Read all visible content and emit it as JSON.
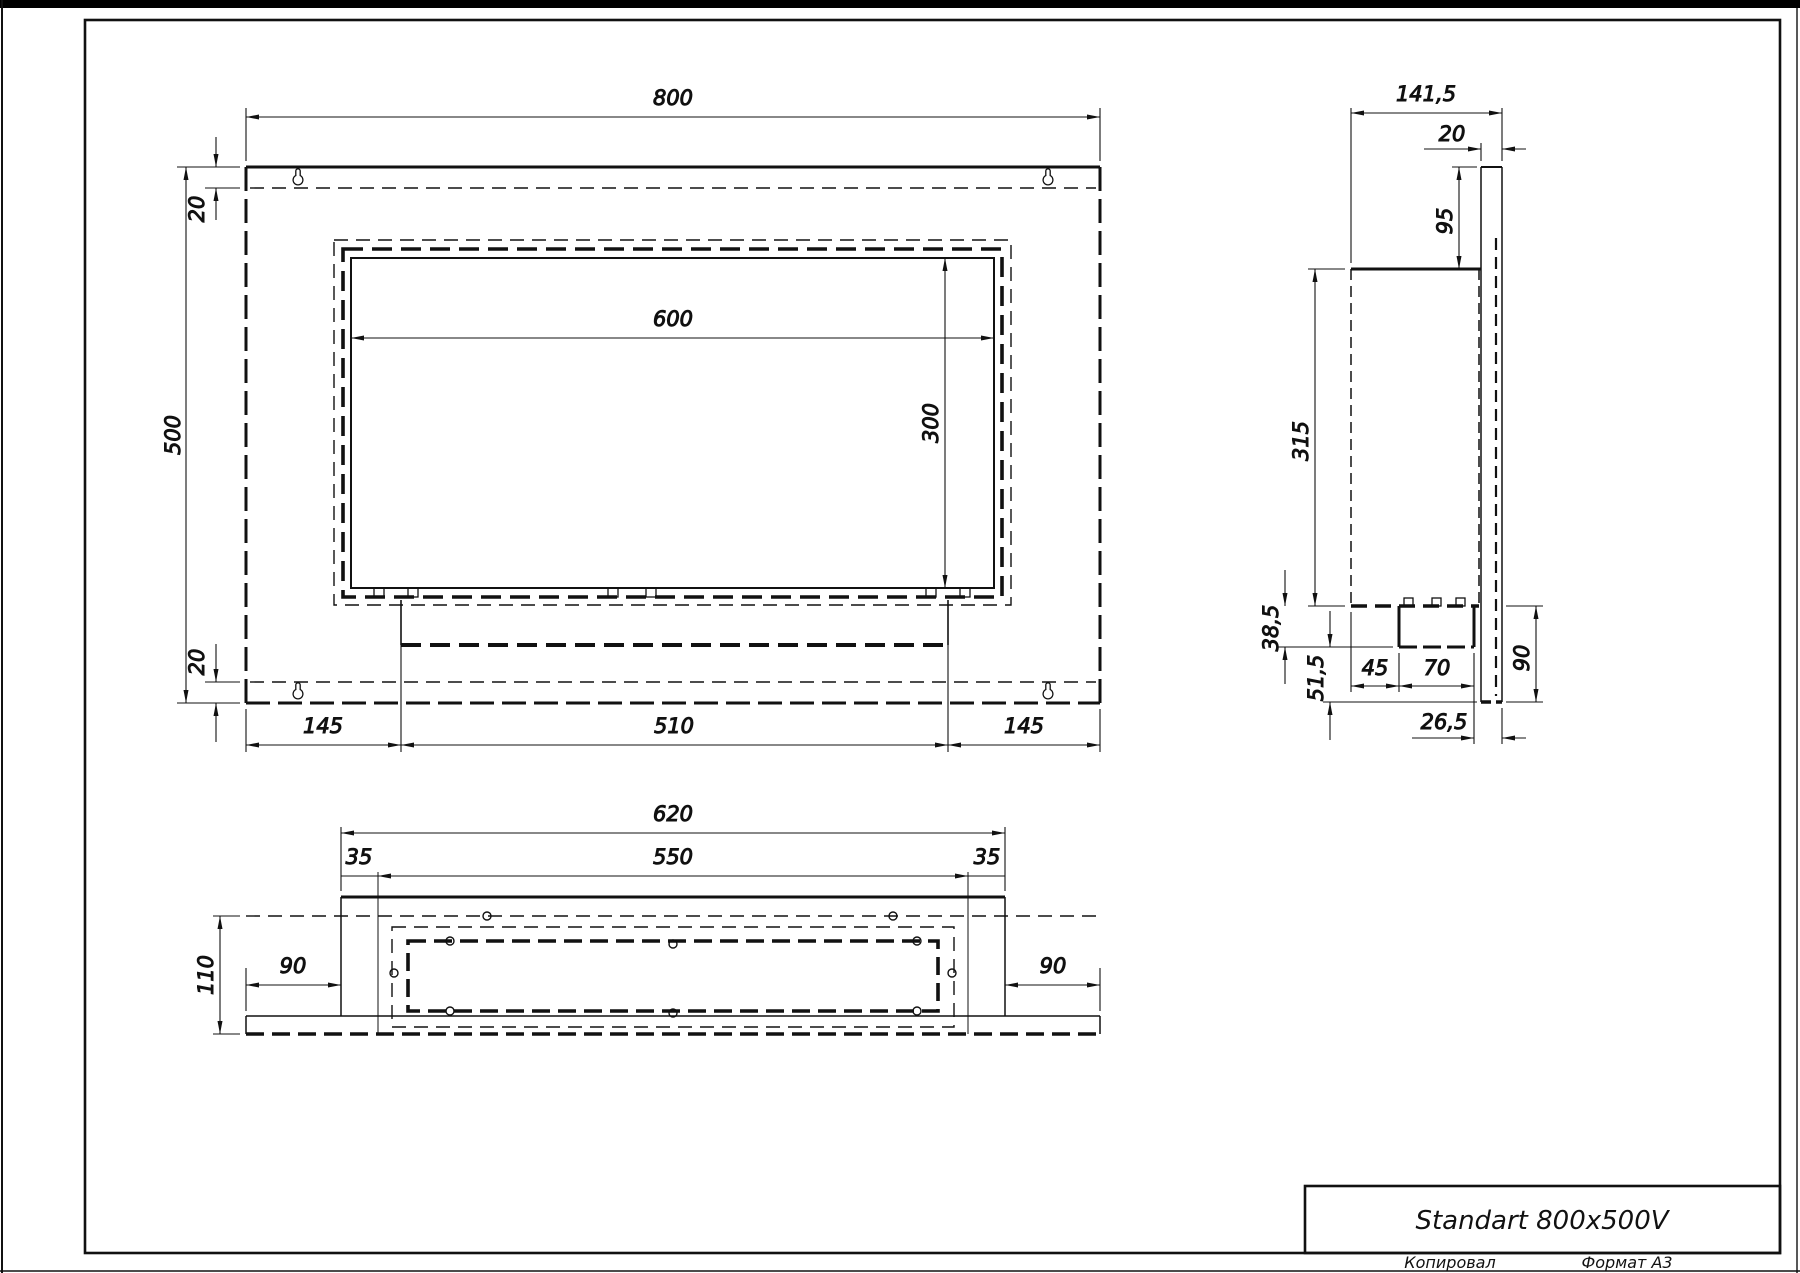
{
  "title_block": {
    "title": "Standart 800x500V",
    "copied": "Копировал",
    "format": "Формат А3"
  },
  "front_view": {
    "dim_width": "800",
    "dim_height": "500",
    "dim_opening_width": "600",
    "dim_opening_height": "300",
    "dim_top_offset": "20",
    "dim_bottom_offset": "20",
    "dim_left_margin": "145",
    "dim_tray_width": "510",
    "dim_right_margin": "145"
  },
  "side_view": {
    "dim_depth": "141,5",
    "dim_plate_thickness": "20",
    "dim_above_body": "95",
    "dim_body_height": "315",
    "dim_tray_drop": "38,5",
    "dim_lower_gap": "51,5",
    "dim_front_gap": "45",
    "dim_tray_depth": "70",
    "dim_back_gap": "26,5",
    "dim_below_body": "90"
  },
  "bottom_view": {
    "dim_width": "620",
    "dim_inner_width": "550",
    "dim_left_inset": "35",
    "dim_right_inset": "35",
    "dim_depth": "110",
    "dim_left_margin": "90",
    "dim_right_margin": "90"
  },
  "colors": {
    "line": "#111111",
    "paper": "#ffffff"
  }
}
